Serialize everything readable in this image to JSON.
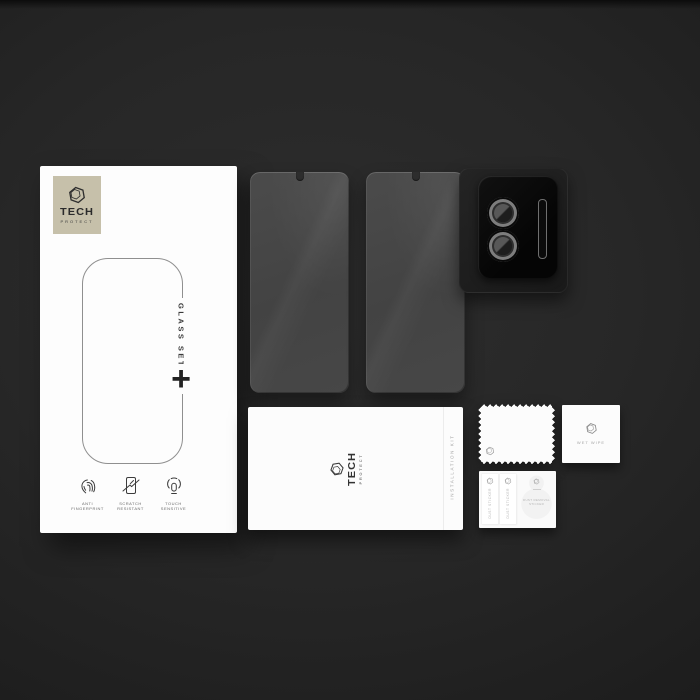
{
  "scene": "Tech-Protect tempered glass set product kit on dark studio background",
  "colors": {
    "background": "#272727",
    "badge_beige": "#c6c0aa",
    "glass_gray": "#474747",
    "camera_protector_black": "#0a0a0a",
    "packet_white": "#fcfcfc",
    "text_dark": "#2e2e2e",
    "text_muted": "#a3a3a3"
  },
  "brand": {
    "line1": "TECH",
    "line2": "PROTECT"
  },
  "box": {
    "glass_set_label": "GLASS SET",
    "plus_glyph": "+",
    "features": [
      {
        "icon": "fingerprint-icon",
        "line1": "ANTI",
        "line2": "FINGERPRINT"
      },
      {
        "icon": "scratch-screen-icon",
        "line1": "SCRATCH",
        "line2": "RESISTANT"
      },
      {
        "icon": "touch-icon",
        "line1": "TOUCH",
        "line2": "SENSITIVE"
      }
    ]
  },
  "installation_kit": {
    "side_label": "INSTALLATION KIT"
  },
  "wet_wipe_packet": {
    "label": "WET WIPE"
  },
  "dust_sticker_card": {
    "strips": [
      {
        "label": "DUST STICKER"
      },
      {
        "label": "DUST STICKER"
      }
    ],
    "blob": {
      "line1": "DUST REMOVAL",
      "line2": "STICKER"
    }
  }
}
